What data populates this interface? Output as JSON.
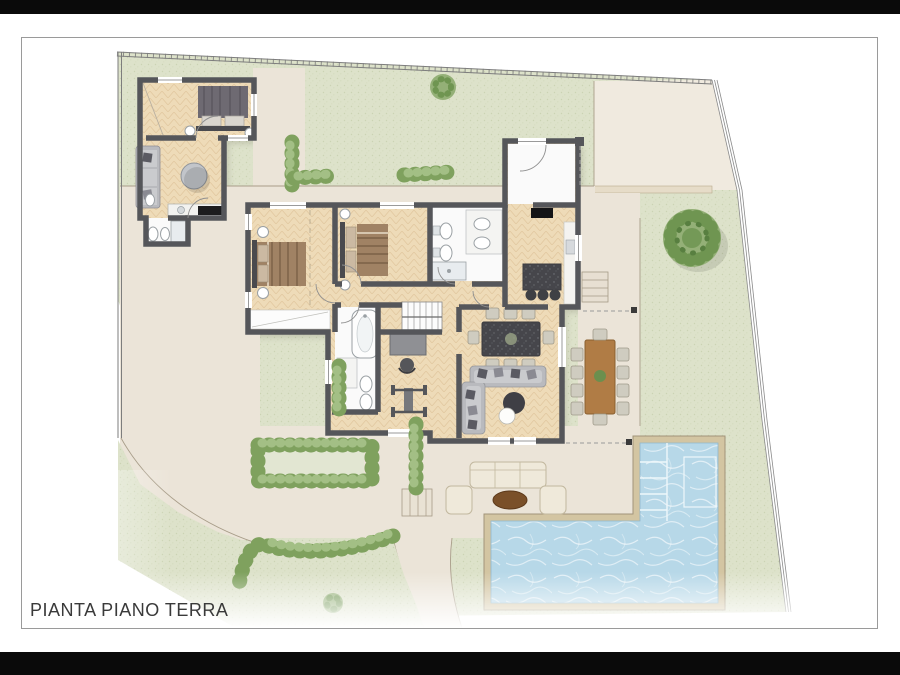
{
  "page": {
    "title": "PIANTA PIANO TERRA"
  },
  "palette": {
    "black": "#0a0a0a",
    "pageBorder": "#9a9a9a",
    "ink": "#3a3a3a",
    "lawn": "#dde2ca",
    "lawnDot": "#b6c297",
    "pave": "#ebe4d8",
    "pave2": "#f0eadf",
    "paveLine": "#a89d89",
    "wall": "#55565a",
    "wood": "#eedbb8",
    "woodLine": "#d6b88c",
    "water": "#b7d8e8",
    "coping": "#d3c5a2",
    "copingLine": "#a2947a",
    "hedge": "#7fa15e",
    "hedgeLight": "#a3bf85",
    "treeLight": "#94b077",
    "treeMid": "#6f9551",
    "granite": "#46464b",
    "outdoorTable": "#b07c45",
    "cream": "#efe9da",
    "sofaGray": "#b9babe",
    "duvetTan": "#a08264",
    "duvetGray": "#6e6a72"
  }
}
